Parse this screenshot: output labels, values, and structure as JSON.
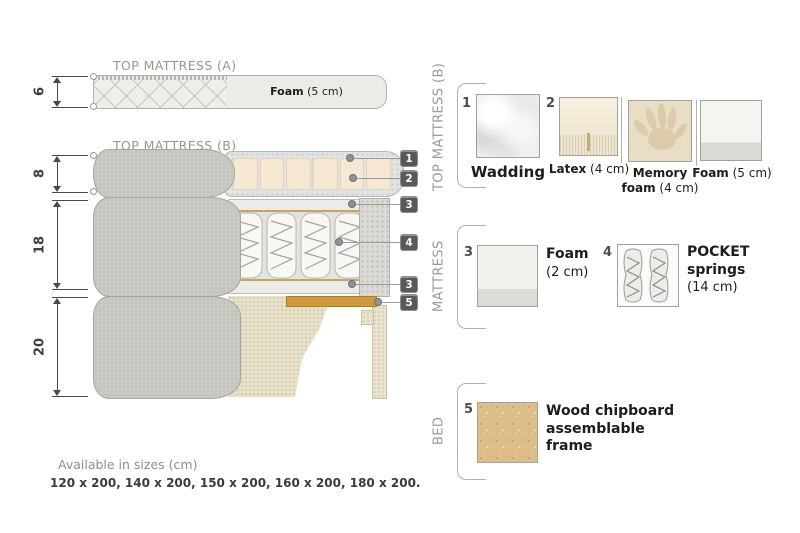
{
  "colors": {
    "fabric_gray": "#cacac4",
    "fabric_beige": "#e7e0cb",
    "latex": "#f6e8d3",
    "memory_foam": "#e9ddc5",
    "wood": "#cf9a3d",
    "chipboard": "#ddbe8a",
    "tag_bg": "#59595b",
    "muted_text": "#97978f"
  },
  "diagram": {
    "titles": {
      "a": "TOP MATTRESS (A)",
      "b": "TOP MATTRESS (B)"
    },
    "dimensions": [
      {
        "value": "6"
      },
      {
        "value": "8"
      },
      {
        "value": "18"
      },
      {
        "value": "20"
      }
    ],
    "foam_label": {
      "bold": "Foam",
      "rest": " (5 cm)"
    },
    "tags": [
      {
        "num": "1"
      },
      {
        "num": "2"
      },
      {
        "num": "3"
      },
      {
        "num": "4"
      },
      {
        "num": "3"
      },
      {
        "num": "5"
      }
    ]
  },
  "legend": {
    "sections": [
      {
        "label": "TOP MATTRESS (B)",
        "items": [
          {
            "num": "1",
            "bold": "Wadding",
            "rest": ""
          },
          {
            "num": "2",
            "bold": "Latex",
            "rest": " (4 cm)"
          },
          {
            "num": "",
            "bold": "Memory foam",
            "rest": " (4 cm)"
          },
          {
            "num": "",
            "bold": "Foam",
            "rest": " (5 cm)"
          }
        ]
      },
      {
        "label": "MATTRESS",
        "items": [
          {
            "num": "3",
            "bold": "Foam",
            "rest": " (2 cm)"
          },
          {
            "num": "4",
            "bold": "POCKET springs",
            "rest": " (14 cm)"
          }
        ]
      },
      {
        "label": "BED",
        "items": [
          {
            "num": "5",
            "bold": "Wood chipboard assemblable frame",
            "rest": ""
          }
        ]
      }
    ]
  },
  "footer": {
    "title": "Available in sizes (cm)",
    "sizes": "120 x 200, 140 x 200, 150 x 200, 160 x 200, 180 x 200."
  }
}
